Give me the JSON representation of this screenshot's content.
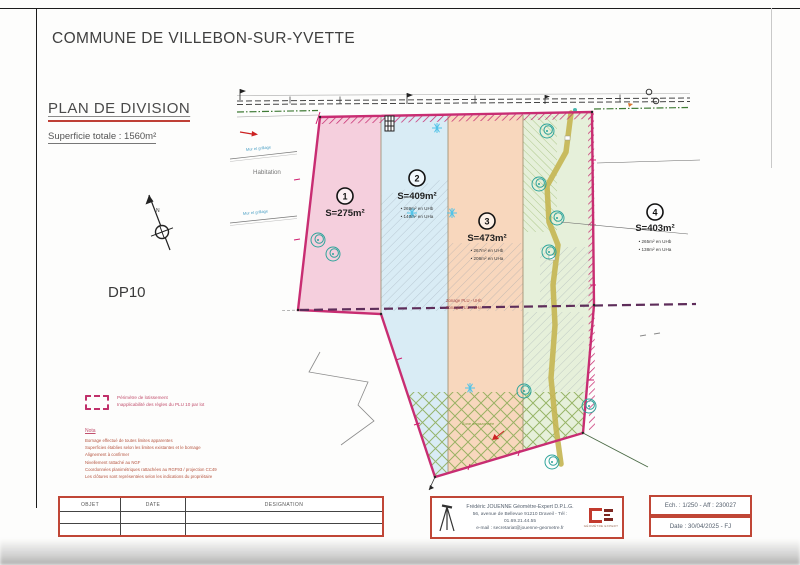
{
  "document": {
    "commune_title": "COMMUNE DE VILLEBON-SUR-YVETTE",
    "plan_title": "PLAN DE DIVISION",
    "total_area": "Superficie totale : 1560m²",
    "sheet_ref": "DP10",
    "north_label": "N"
  },
  "plan": {
    "parcels": [
      {
        "num": "1",
        "area": "S=275m²",
        "detail1": "",
        "detail2": ""
      },
      {
        "num": "2",
        "area": "S=409m²",
        "detail1": "• 269m² en UHb",
        "detail2": "• 140m² en UHa"
      },
      {
        "num": "3",
        "area": "S=473m²",
        "detail1": "• 267m² en UHb",
        "detail2": "• 206m² en UHa"
      },
      {
        "num": "4",
        "area": "S=403m²",
        "detail1": "• 265m² en UHb",
        "detail2": "• 138m² en UHa"
      }
    ],
    "labels": {
      "habitation": "Habitation",
      "wall_top": "Mur et grillage",
      "wall_bottom": "Mur et grillage",
      "zonage_upper": "Zonage PLU - UHb",
      "zonage_lower": "Zonage PLU - UHa",
      "green_zone": "Zone engazonnée"
    }
  },
  "legend": {
    "perimeter_line1": "Périmètre de lotissement",
    "perimeter_line2": "Inapplicabilité des règles du PLU 10 par lot"
  },
  "notes": {
    "title": "Nota",
    "lines": [
      "Bornage effectué de toutes limites apparentes",
      "Superficies établies selon les limites existantes et le bornage",
      "Alignement à confirmer",
      "Nivellement rattaché au NGF",
      "Coordonnées planimétriques rattachées au RGF93 / projection CC49",
      "Les clôtures sont représentées selon les indications du propriétaire"
    ]
  },
  "revision_table": {
    "headers": [
      "OBJET",
      "DATE",
      "DESIGNATION"
    ]
  },
  "surveyor": {
    "name_line": "Frédéric JOUENNE Géomètre-Expert D.P.L.G.",
    "address_line": "56, avenue de Bellevue 91210 Draveil - Tél : 01.69.21.44.55",
    "email_line": "e-mail : secretariat@jouenne-geometre.fr",
    "logo_caption": "GÉOMÈTRE EXPERT"
  },
  "title_block": {
    "scale_ref": "Ech. : 1/250 - Aff : 230027",
    "date_ref": "Date : 30/04/2025 - FJ"
  },
  "colors": {
    "parcel1_fill": "#f5cfdd",
    "parcel2_fill": "#d9ecf5",
    "parcel3_fill": "#f8d7bd",
    "parcel4_fill": "#e6f0da",
    "boundary": "#c82d72",
    "accent_red": "#c0392b",
    "path_olive": "#c6b655"
  }
}
